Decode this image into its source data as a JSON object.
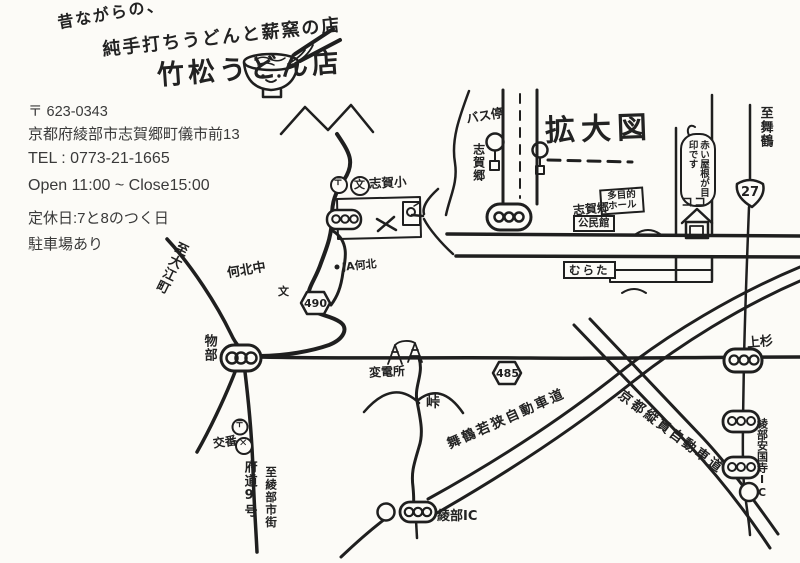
{
  "colors": {
    "ink": "#1f1f1f",
    "paper": "#fcfbf7",
    "print_text": "#3a3a3a"
  },
  "header": {
    "tagline1": "昔ながらの、",
    "tagline2": "純手打ちうどんと薪窯の店",
    "shop_name": "竹松うどん店",
    "icon": "udon-bowl-icon"
  },
  "info": {
    "postal_code": "〒 623-0343",
    "address": "京都府綾部市志賀郷町儀市前13",
    "tel": "TEL : 0773-21-1665",
    "hours": "Open 11:00 ~ Close15:00",
    "closed": "定休日:7と8のつく日",
    "parking": "駐車場あり"
  },
  "inset": {
    "title": "拡大図",
    "bus_stop": "バス停",
    "district": "志賀郷",
    "to_maizuru": "至舞鶴",
    "route27": "27",
    "landmark_note": "赤い屋根が目印です",
    "here": "ココ",
    "hall": "多目的ホール",
    "district2": "志賀郷",
    "community_center": "公民館",
    "murata": "むらた"
  },
  "map": {
    "elementary_school": "志賀小",
    "postal_mark": "〒",
    "school_mark": "文",
    "police_mark": "✕",
    "ja_branch": "JA何北",
    "junior_high": "何北中",
    "route490": "490",
    "route485": "485",
    "to_oecho": "至大江町",
    "monobe": "物部",
    "koban": "交番",
    "pref_road9": "府道9号",
    "to_ayabe_city": "至綾部市街",
    "substation": "変電所",
    "pass": "峠",
    "maizuru_wakasa_expwy": "舞鶴若狭自動車道",
    "kyoto_judan_expwy": "京都縦貫自動車道",
    "ayabe_ic": "綾部IC",
    "uesugi": "上杉",
    "ayabe_ankokuji_ic": "綾部安国寺IC"
  }
}
